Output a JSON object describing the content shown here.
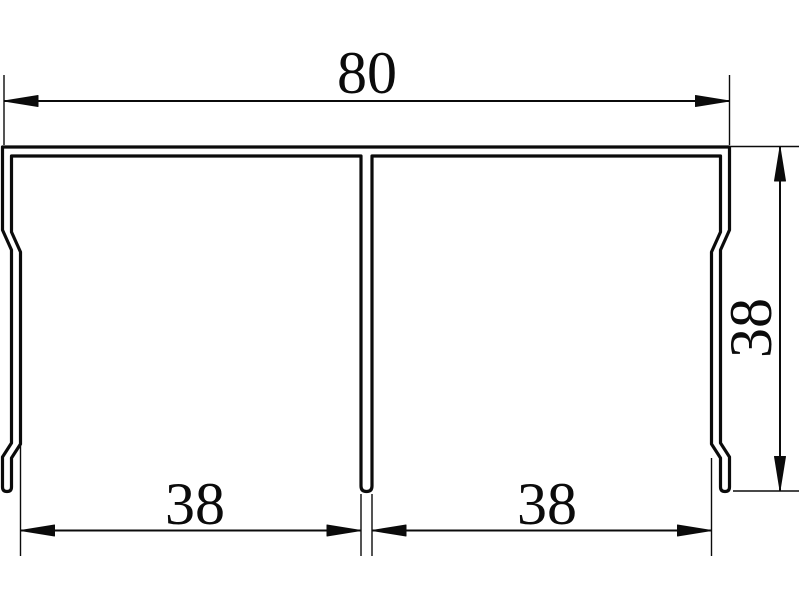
{
  "drawing": {
    "kind": "profile-cross-section",
    "colors": {
      "line": "#0b0b0b",
      "background": "#ffffff"
    },
    "dimensions": {
      "overall_width": {
        "value": "80",
        "position": "top",
        "orientation": "horizontal"
      },
      "side_height": {
        "value": "38",
        "position": "right",
        "orientation": "vertical"
      },
      "left_opening": {
        "value": "38",
        "position": "bottom-left",
        "orientation": "horizontal"
      },
      "right_opening": {
        "value": "38",
        "position": "bottom-right",
        "orientation": "horizontal"
      }
    }
  }
}
